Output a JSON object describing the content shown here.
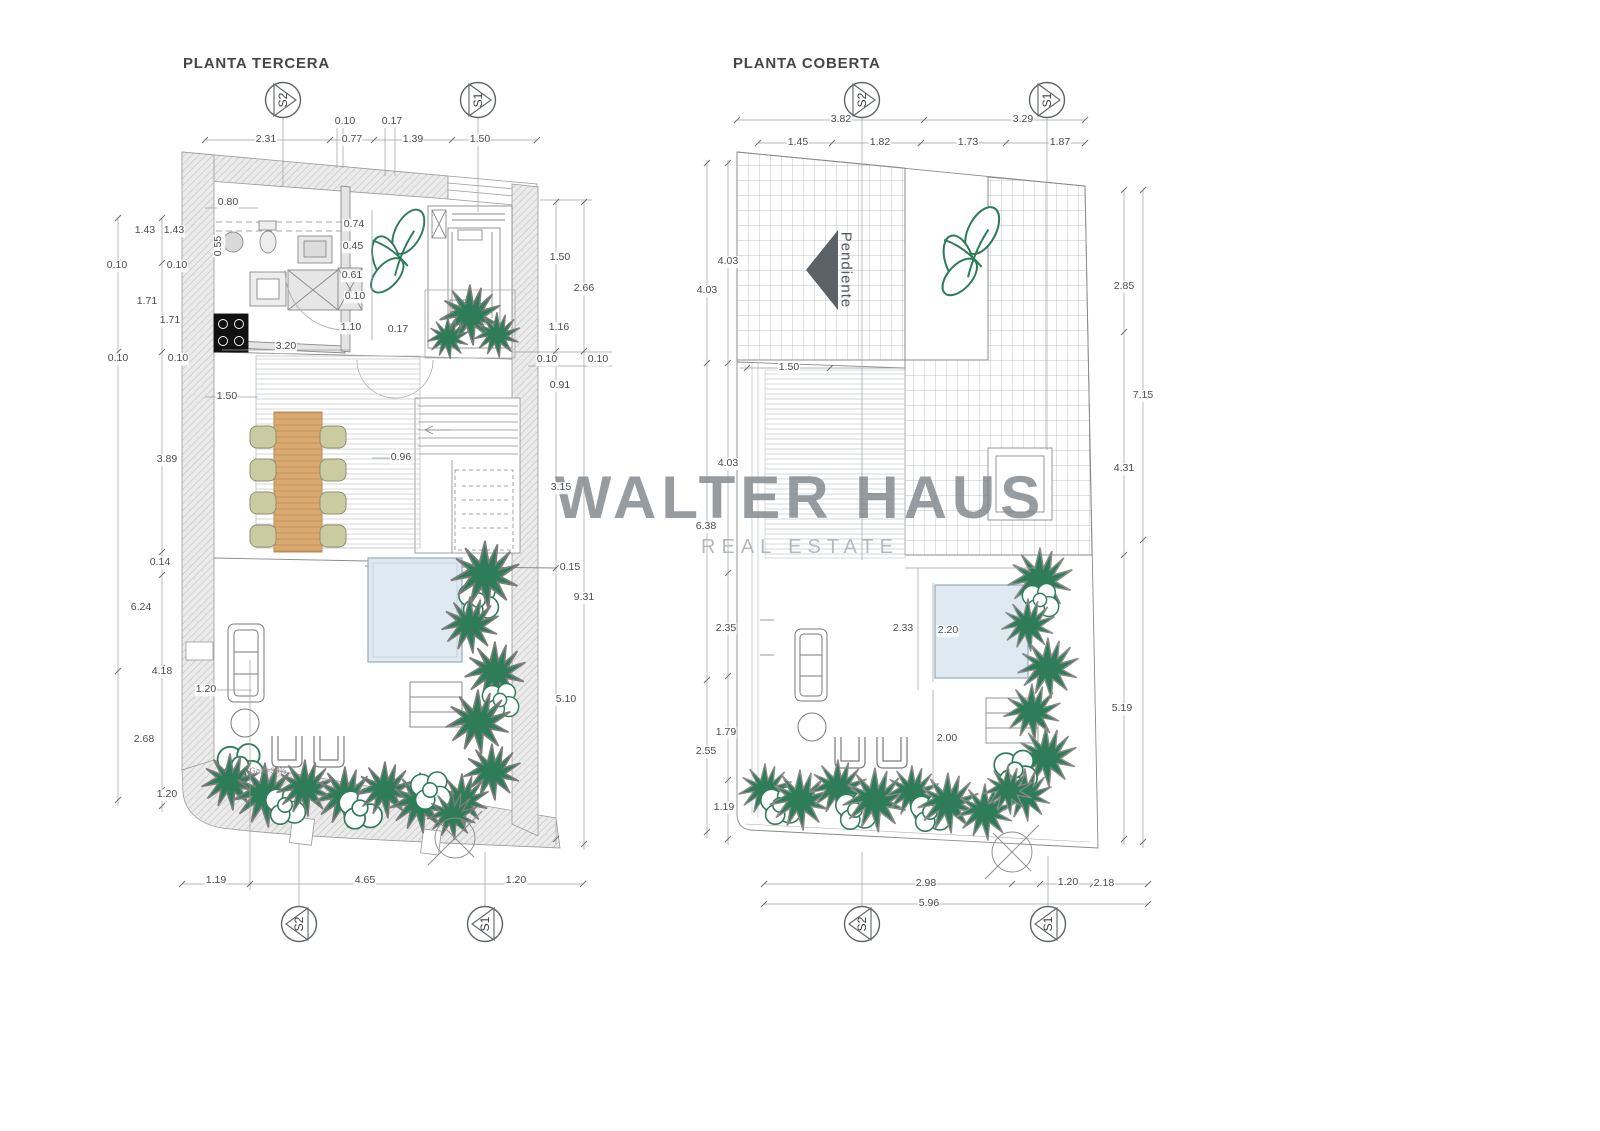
{
  "watermark": {
    "line1": "WALTER HAUS",
    "line2": "REAL ESTATE",
    "color": "#81878c",
    "sub_color": "#b4b9bc"
  },
  "colors": {
    "plant": "#2e7c58",
    "pool": "#dfe9f1",
    "wood": "#d9a972",
    "wall_hatch": "#ebebeb",
    "line": "#7d7d7d",
    "dim_text": "#4b4b4b",
    "pendiente_arrow": "#5c6165",
    "stove": "#111111"
  },
  "plans": [
    {
      "id": "planta-tercera",
      "title": "PLANTA TERCERA",
      "title_pos": {
        "x": 183,
        "y": 55
      },
      "section_markers": [
        {
          "label": "S2",
          "x": 283,
          "y": 100,
          "dir": "r"
        },
        {
          "label": "S1",
          "x": 478,
          "y": 100,
          "dir": "r"
        },
        {
          "label": "S2",
          "x": 299,
          "y": 924,
          "dir": "l"
        },
        {
          "label": "S1",
          "x": 485,
          "y": 924,
          "dir": "l"
        }
      ],
      "dims": [
        {
          "t": "0.10",
          "x": 345,
          "y": 122
        },
        {
          "t": "0.17",
          "x": 392,
          "y": 122
        },
        {
          "t": "2.31",
          "x": 266,
          "y": 140
        },
        {
          "t": "0.77",
          "x": 352,
          "y": 140
        },
        {
          "t": "1.39",
          "x": 413,
          "y": 140
        },
        {
          "t": "1.50",
          "x": 480,
          "y": 140
        },
        {
          "t": "1.43",
          "x": 145,
          "y": 231
        },
        {
          "t": "1.43",
          "x": 174,
          "y": 231
        },
        {
          "t": "0.10",
          "x": 117,
          "y": 266
        },
        {
          "t": "0.10",
          "x": 177,
          "y": 266
        },
        {
          "t": "1.71",
          "x": 147,
          "y": 302
        },
        {
          "t": "1.71",
          "x": 170,
          "y": 321
        },
        {
          "t": "0.10",
          "x": 118,
          "y": 359
        },
        {
          "t": "0.10",
          "x": 178,
          "y": 359
        },
        {
          "t": "3.89",
          "x": 167,
          "y": 460
        },
        {
          "t": "0.14",
          "x": 160,
          "y": 563
        },
        {
          "t": "6.24",
          "x": 141,
          "y": 608
        },
        {
          "t": "4.18",
          "x": 162,
          "y": 672
        },
        {
          "t": "2.68",
          "x": 144,
          "y": 740
        },
        {
          "t": "1.20",
          "x": 167,
          "y": 795
        },
        {
          "t": "1.19",
          "x": 216,
          "y": 881
        },
        {
          "t": "4.65",
          "x": 365,
          "y": 881
        },
        {
          "t": "1.20",
          "x": 516,
          "y": 881
        },
        {
          "t": "1.50",
          "x": 560,
          "y": 258
        },
        {
          "t": "2.66",
          "x": 584,
          "y": 289
        },
        {
          "t": "1.16",
          "x": 559,
          "y": 328
        },
        {
          "t": "0.10",
          "x": 547,
          "y": 360
        },
        {
          "t": "0.10",
          "x": 598,
          "y": 360
        },
        {
          "t": "0.91",
          "x": 560,
          "y": 386
        },
        {
          "t": "3.15",
          "x": 561,
          "y": 488
        },
        {
          "t": "0.15",
          "x": 570,
          "y": 568
        },
        {
          "t": "9.31",
          "x": 584,
          "y": 598
        },
        {
          "t": "5.10",
          "x": 566,
          "y": 700
        },
        {
          "t": "0.80",
          "x": 228,
          "y": 203
        },
        {
          "t": "0.55",
          "x": 219,
          "y": 246,
          "r": -90
        },
        {
          "t": "0.74",
          "x": 354,
          "y": 225
        },
        {
          "t": "0.45",
          "x": 353,
          "y": 247
        },
        {
          "t": "0.61",
          "x": 352,
          "y": 276
        },
        {
          "t": "0.10",
          "x": 355,
          "y": 297
        },
        {
          "t": "1.10",
          "x": 351,
          "y": 328
        },
        {
          "t": "0.17",
          "x": 398,
          "y": 330
        },
        {
          "t": "3.20",
          "x": 286,
          "y": 347
        },
        {
          "t": "1.50",
          "x": 227,
          "y": 397
        },
        {
          "t": "0.96",
          "x": 401,
          "y": 458
        },
        {
          "t": "1.20",
          "x": 206,
          "y": 690
        },
        {
          "t": "Galib 30%",
          "x": 268,
          "y": 772,
          "s": 8,
          "c": "#8a8a8a",
          "bg": false
        }
      ]
    },
    {
      "id": "planta-coberta",
      "title": "PLANTA COBERTA",
      "title_pos": {
        "x": 733,
        "y": 55
      },
      "section_markers": [
        {
          "label": "S2",
          "x": 862,
          "y": 100,
          "dir": "r"
        },
        {
          "label": "S1",
          "x": 1047,
          "y": 100,
          "dir": "r"
        },
        {
          "label": "S2",
          "x": 862,
          "y": 924,
          "dir": "l"
        },
        {
          "label": "S1",
          "x": 1048,
          "y": 924,
          "dir": "l"
        }
      ],
      "dims": [
        {
          "t": "3.82",
          "x": 841,
          "y": 120
        },
        {
          "t": "3.29",
          "x": 1023,
          "y": 120
        },
        {
          "t": "1.45",
          "x": 798,
          "y": 143
        },
        {
          "t": "1.82",
          "x": 880,
          "y": 143
        },
        {
          "t": "1.73",
          "x": 968,
          "y": 143
        },
        {
          "t": "1.87",
          "x": 1060,
          "y": 143
        },
        {
          "t": "4.03",
          "x": 728,
          "y": 262
        },
        {
          "t": "4.03",
          "x": 707,
          "y": 291
        },
        {
          "t": "4.03",
          "x": 728,
          "y": 464
        },
        {
          "t": "6.38",
          "x": 706,
          "y": 527
        },
        {
          "t": "2.35",
          "x": 726,
          "y": 629
        },
        {
          "t": "1.79",
          "x": 726,
          "y": 733
        },
        {
          "t": "2.55",
          "x": 706,
          "y": 752
        },
        {
          "t": "1.19",
          "x": 724,
          "y": 808
        },
        {
          "t": "2.85",
          "x": 1124,
          "y": 287
        },
        {
          "t": "7.15",
          "x": 1143,
          "y": 396
        },
        {
          "t": "4.31",
          "x": 1124,
          "y": 469
        },
        {
          "t": "5.19",
          "x": 1122,
          "y": 709
        },
        {
          "t": "1.20",
          "x": 1068,
          "y": 883
        },
        {
          "t": "1.50",
          "x": 789,
          "y": 368
        },
        {
          "t": "2.33",
          "x": 903,
          "y": 629
        },
        {
          "t": "2.20",
          "x": 948,
          "y": 631
        },
        {
          "t": "2.00",
          "x": 947,
          "y": 739
        },
        {
          "t": "2.98",
          "x": 926,
          "y": 884
        },
        {
          "t": "2.18",
          "x": 1104,
          "y": 884
        },
        {
          "t": "5.96",
          "x": 929,
          "y": 904
        },
        {
          "t": "Pendiente",
          "x": 845,
          "y": 270,
          "r": 90,
          "s": 15,
          "c": "#555a5e",
          "ls": 1,
          "bg": false
        }
      ]
    }
  ]
}
